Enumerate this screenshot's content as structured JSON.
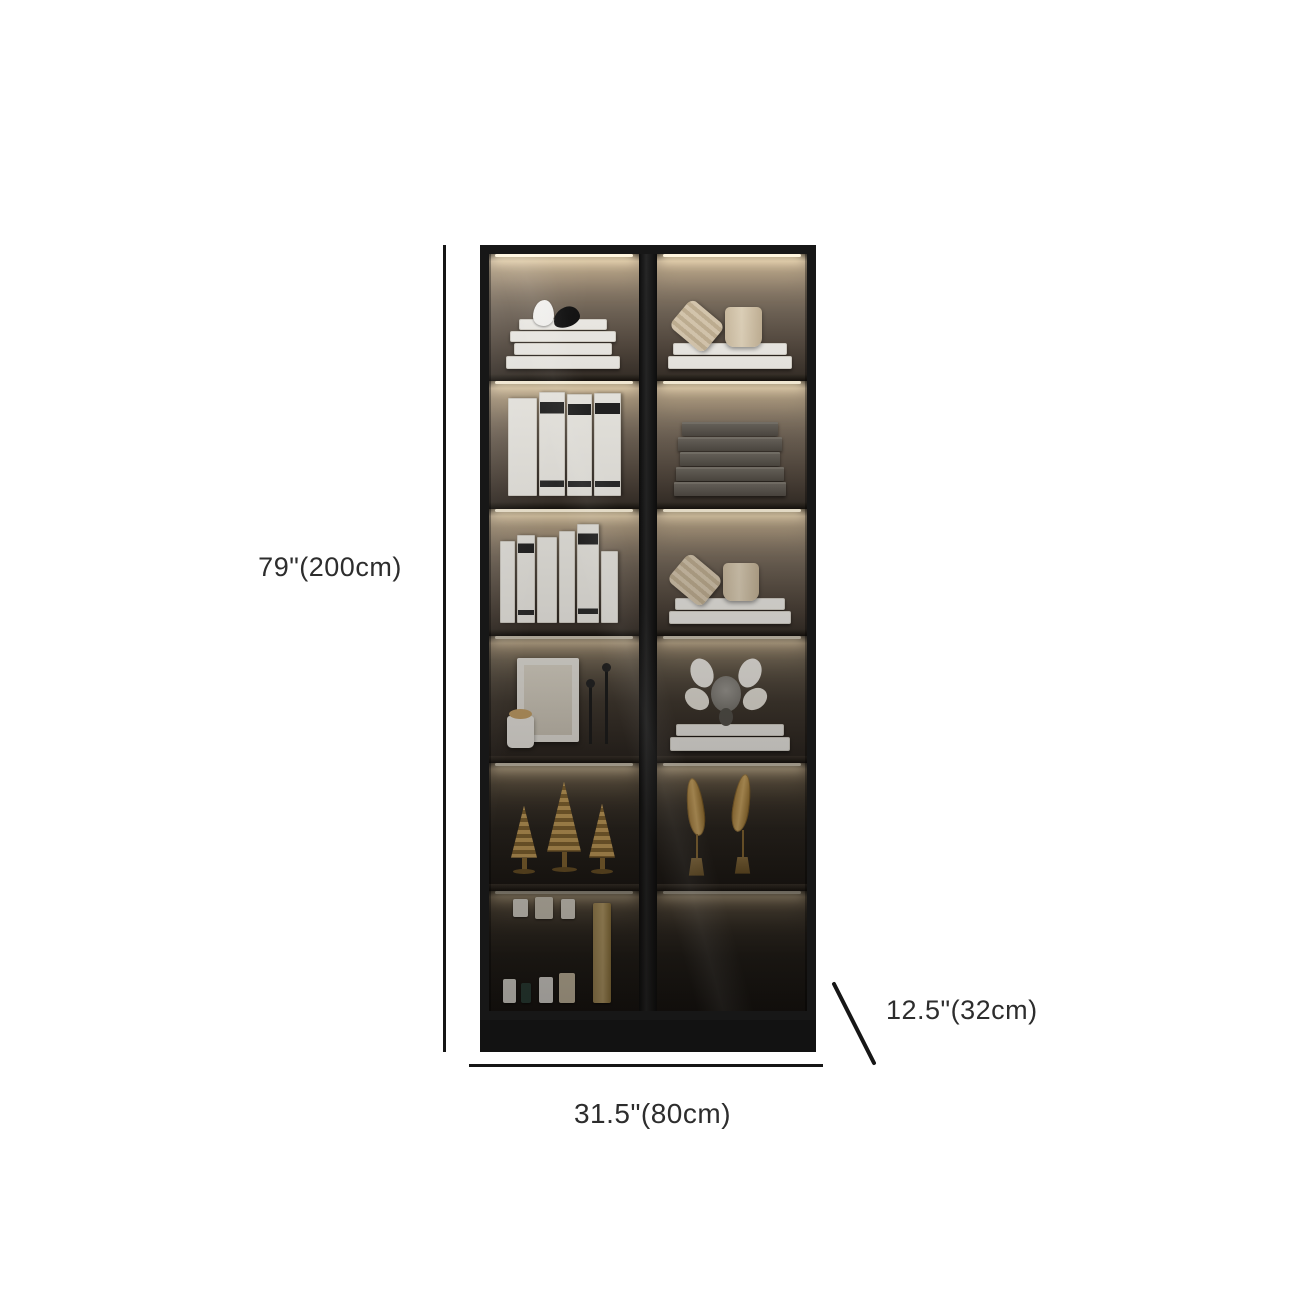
{
  "page": {
    "background_color": "#ffffff",
    "description": "product-dimension-photo-of-glass-door-display-bookcase"
  },
  "annotations": {
    "height": {
      "label": "79\"(200cm)"
    },
    "width": {
      "label": "31.5\"(80cm)"
    },
    "depth": {
      "label": "12.5\"(32cm)"
    },
    "line_color": "#161616",
    "text_color": "#2d2d2d"
  },
  "cabinet": {
    "frame_color": "#171717",
    "led_glow_color": "#fff5de",
    "columns": 2,
    "rows": 6,
    "shelves": [
      {
        "row": 1,
        "left": "white-and-black-bird-figurines-on-white-book-stack",
        "right": "two-beige-cups-on-white-book-stack"
      },
      {
        "row": 2,
        "left": "standing-white-books",
        "right": "stack-of-dark-gray-boxes"
      },
      {
        "row": 3,
        "left": "standing-white-books-and-magazines",
        "right": "beige-cups-on-white-book-stack"
      },
      {
        "row": 4,
        "left": "picture-frame-candle-jar-and-black-candlesticks",
        "right": "gray-monkey-figurine-on-two-white-books"
      },
      {
        "row": 5,
        "left": "three-gold-spiral-cone-ornaments",
        "right": "two-gold-feather-ornaments-on-stands"
      },
      {
        "row": 6,
        "left": "small-cosmetic-bottles-and-tall-tan-book",
        "right": "empty"
      }
    ]
  }
}
